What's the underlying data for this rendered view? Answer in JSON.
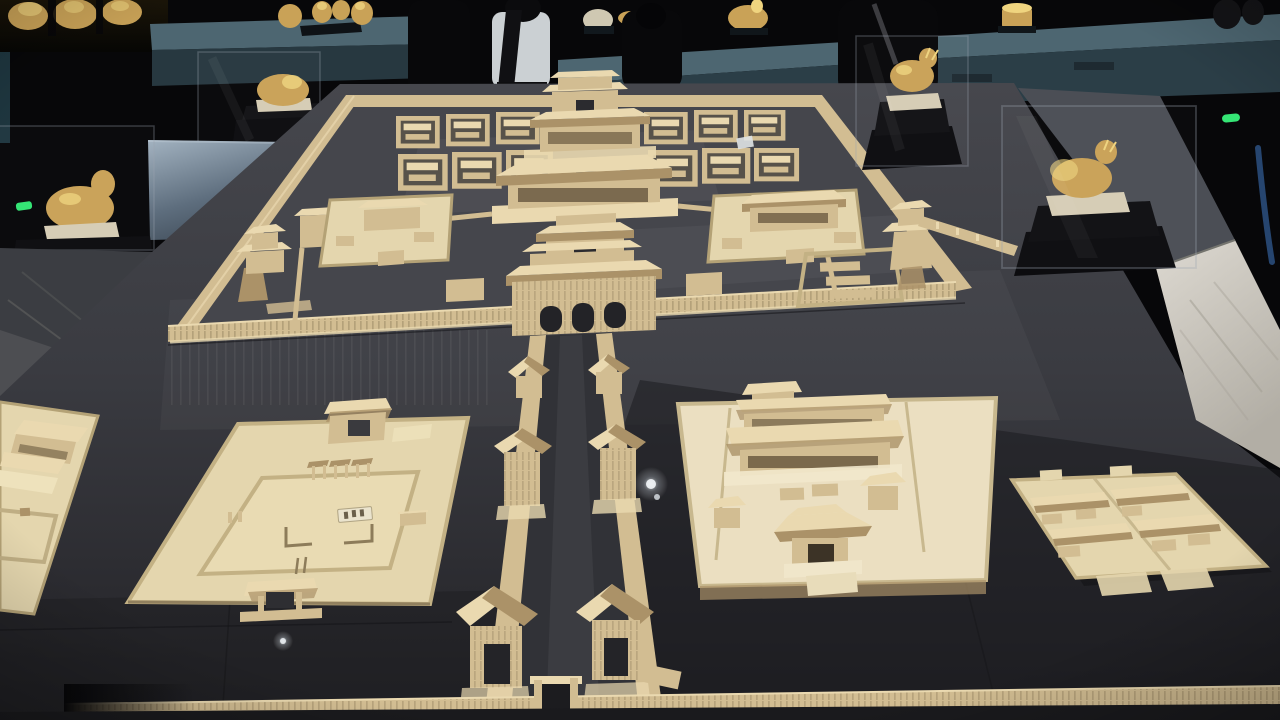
{
  "scene": {
    "description": "Dim museum gallery: a large wooden scale model of an ancient Chinese imperial palace city displayed on a dark exhibit table, with glass cases of golden animal statuettes, a lit wall counter of gold artifacts, visitor silhouettes, marble floor strips and green exit lights",
    "colors": {
      "room": "#070709",
      "wood_light": "#ead9b0",
      "wood_mid": "#d2bd92",
      "wood_dark": "#ab9268",
      "wood_shadow": "#6f5f44",
      "platform_light": "#e4d6ae",
      "platform_cream": "#ebdfc1",
      "palace_ground": "#45464c",
      "table_light": "#46474d",
      "table_dark": "#26262b",
      "road": "#313237",
      "gold": "#c9a257",
      "gold_bright": "#efd47f",
      "pale_base": "#d6cdb5",
      "pedestal": "#0c0c0f",
      "counter_teal": "#4d6671",
      "counter_teal_dark": "#2b3e47",
      "aisle_gray": "#4b4e55",
      "marble": "#d5d2ca",
      "marble_streak": "#a29e94",
      "card_white": "#dfe3e6",
      "glass_edge": "#9aa6b0",
      "led_green": "#35e575",
      "rope_blue": "#26456f",
      "silhouette": "#08080a",
      "shirt_white": "#cbd0d3"
    }
  },
  "gallery": {
    "counter_label": "wall display counter with golden artifacts",
    "relief_shelf_label": "lit shelf of golden relief ornaments",
    "case_labels": {
      "far_left": "glass case with golden beast statuette",
      "mid_left": "glass case with small golden statuette",
      "right_small": "glass case with golden deer statuette",
      "right_large": "glass case with golden tapir statuette"
    },
    "visitor_count": 4,
    "exit_light_count": 2
  },
  "model": {
    "label": "wooden architectural model of imperial palace complex",
    "sections": {
      "palace": "walled palace compound with axial gate halls and courtyard clusters",
      "axis": "central axial way flanked by corridor walls with gate towers",
      "left_enclosure": "flat walled altar enclosure with inner square and name plaque",
      "far_left_enclosure": "partially visible walled enclosure with hall group",
      "right_enclosure": "walled temple courtyard with great halls and gate pavilion",
      "residential_block": "grid of small courtyard residences",
      "south_wall": "long outer city wall with central gate"
    }
  }
}
